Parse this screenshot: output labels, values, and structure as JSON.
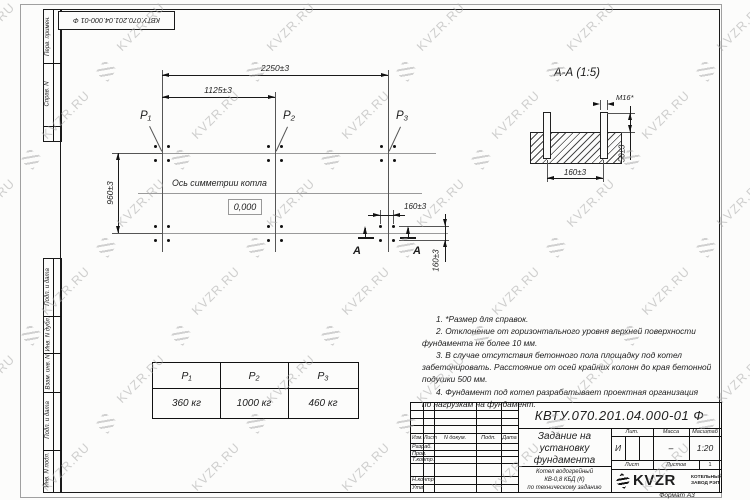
{
  "designation": "КВТУ.070.201.04.000-01 Ф",
  "watermark": {
    "text": "KVZR.RU"
  },
  "margin_labels": {
    "items": [
      "Перв. примен.",
      "Справ. N",
      "Подп. и дата",
      "Инв. N дубл.",
      "Взам. инв. N",
      "Подп. и дата",
      "Инв. N подл."
    ]
  },
  "plan": {
    "dim_total": "2250±3",
    "dim_half": "1125±3",
    "dim_width": "960±3",
    "dim_bolt_x": "160±3",
    "dim_bolt_y": "160±3",
    "axis_label": "Ось симметрии котла",
    "zero_mark": "0,000",
    "p1": "P₁",
    "p2": "P₂",
    "p3": "P₃",
    "section_letter": "А"
  },
  "section_view": {
    "title": "А-А (1:5)",
    "thread": "М16*",
    "dim_height": "50±3",
    "dim_spacing": "160±3"
  },
  "notes": {
    "lines": [
      "1. *Размер для справок.",
      "2. Отклонение от горизонтального уровня верхней поверхности",
      "фундамента не более 10 мм.",
      "3. В случае отсутствия бетонного пола площадку под котел",
      "забетонировать. Расстояние от осей крайних колонн до края бетонной",
      "подушки 500 мм.",
      "4. Фундамент под котел разрабатывает проектная организация",
      "по нагрузкам на фундамент."
    ]
  },
  "load_table": {
    "columns": [
      "P₁",
      "P₂",
      "P₃"
    ],
    "values": [
      "360 кг",
      "1000 кг",
      "460 кг"
    ]
  },
  "title_block": {
    "doc_title_lines": [
      "Задание на",
      "установку",
      "фундамента"
    ],
    "product_lines": [
      "Котел водогрейный",
      "КВ-0,8 КБД (К)",
      "по техническому заданию"
    ],
    "col_izm": "Изм.",
    "col_list": "Лист",
    "col_doc": "N докум.",
    "col_podp": "Подп.",
    "col_data": "Дата",
    "row_razrab": "Разраб.",
    "row_prov": "Пров.",
    "row_tkontr": "Т.контр.",
    "row_nkontr": "Н.контр.",
    "row_utv": "Утв.",
    "lit_label": "Лит.",
    "massa_label": "Масса",
    "masshtab_label": "Масштаб",
    "lit_value": "И",
    "massa_value": "–",
    "scale_value": "1:20",
    "list_label": "Лист",
    "listov_label": "Листов",
    "listov_value": "1",
    "logo_text": "KVZR",
    "company_line1": "КОТЕЛЬНЫЙ",
    "company_line2": "ЗАВОД РЭП",
    "format_label": "Формат А3"
  }
}
